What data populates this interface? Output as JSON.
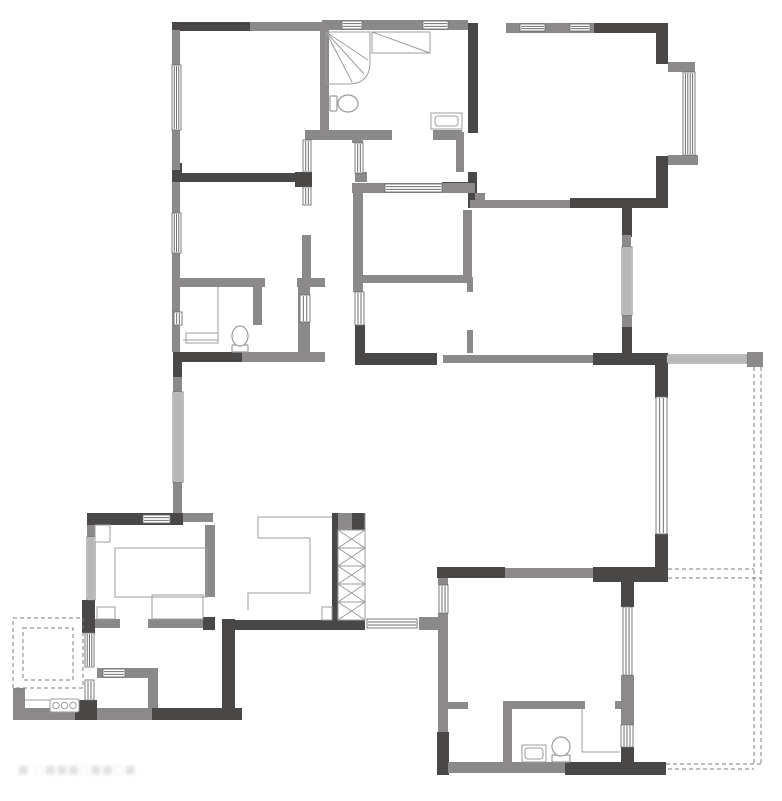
{
  "title": "apartment-floor-plan",
  "watermark": {
    "text": "■ □■■■□■■□■"
  },
  "colors": {
    "wall_dark": "#4a4747",
    "wall_mid": "#8b8989",
    "thin_line": "#9c9c9c",
    "window_frame": "#6f6f6f",
    "dashed": "#7d7d7d",
    "background": "#ffffff"
  },
  "plan": {
    "width": 782,
    "height": 801,
    "walls_dark": [
      [
        172,
        22,
        78,
        9
      ],
      [
        594,
        23,
        74,
        10
      ],
      [
        656,
        23,
        12,
        41
      ],
      [
        656,
        156,
        12,
        52
      ],
      [
        468,
        23,
        10,
        110
      ],
      [
        468,
        172,
        9,
        36
      ],
      [
        570,
        198,
        98,
        10
      ],
      [
        172,
        163,
        10,
        19
      ],
      [
        172,
        173,
        138,
        9
      ],
      [
        295,
        172,
        17,
        15
      ],
      [
        442,
        182,
        33,
        9
      ],
      [
        622,
        208,
        10,
        29
      ],
      [
        622,
        325,
        10,
        40
      ],
      [
        173,
        352,
        9,
        26
      ],
      [
        173,
        352,
        69,
        10
      ],
      [
        355,
        325,
        10,
        40
      ],
      [
        355,
        353,
        82,
        12
      ],
      [
        593,
        353,
        74,
        12
      ],
      [
        655,
        353,
        13,
        45
      ],
      [
        655,
        534,
        13,
        48
      ],
      [
        593,
        567,
        75,
        15
      ],
      [
        437,
        567,
        68,
        11
      ],
      [
        87,
        513,
        96,
        12
      ],
      [
        82,
        600,
        13,
        33
      ],
      [
        75,
        700,
        22,
        20
      ],
      [
        152,
        708,
        90,
        12
      ],
      [
        222,
        619,
        13,
        91
      ],
      [
        203,
        617,
        12,
        13
      ],
      [
        235,
        620,
        130,
        10
      ],
      [
        332,
        513,
        6,
        109
      ],
      [
        348,
        513,
        17,
        17
      ],
      [
        437,
        732,
        12,
        43
      ],
      [
        565,
        762,
        101,
        13
      ],
      [
        621,
        578,
        13,
        29
      ],
      [
        621,
        747,
        13,
        28
      ]
    ],
    "walls_mid": [
      [
        250,
        22,
        72,
        9
      ],
      [
        322,
        20,
        146,
        10
      ],
      [
        506,
        23,
        88,
        10
      ],
      [
        668,
        62,
        27,
        10
      ],
      [
        668,
        155,
        30,
        10
      ],
      [
        172,
        30,
        8,
        140
      ],
      [
        320,
        23,
        9,
        110
      ],
      [
        305,
        130,
        87,
        10
      ],
      [
        433,
        130,
        29,
        10
      ],
      [
        456,
        132,
        8,
        40
      ],
      [
        352,
        133,
        11,
        10
      ],
      [
        355,
        172,
        12,
        10
      ],
      [
        172,
        182,
        8,
        170
      ],
      [
        302,
        235,
        9,
        48
      ],
      [
        175,
        278,
        90,
        9
      ],
      [
        297,
        278,
        28,
        9
      ],
      [
        253,
        287,
        9,
        38
      ],
      [
        298,
        287,
        12,
        65
      ],
      [
        242,
        352,
        83,
        10
      ],
      [
        352,
        183,
        123,
        10
      ],
      [
        353,
        193,
        10,
        99
      ],
      [
        363,
        275,
        107,
        8
      ],
      [
        463,
        210,
        9,
        67
      ],
      [
        467,
        277,
        6,
        15
      ],
      [
        467,
        330,
        6,
        23
      ],
      [
        470,
        200,
        100,
        8
      ],
      [
        475,
        193,
        10,
        10
      ],
      [
        622,
        235,
        9,
        12
      ],
      [
        622,
        315,
        10,
        12
      ],
      [
        443,
        355,
        150,
        8
      ],
      [
        173,
        377,
        9,
        15
      ],
      [
        173,
        482,
        9,
        31
      ],
      [
        183,
        513,
        30,
        9
      ],
      [
        87,
        525,
        8,
        12
      ],
      [
        95,
        619,
        25,
        9
      ],
      [
        148,
        619,
        55,
        9
      ],
      [
        205,
        525,
        10,
        72
      ],
      [
        97,
        668,
        61,
        10
      ],
      [
        148,
        678,
        10,
        30
      ],
      [
        13,
        688,
        12,
        32
      ],
      [
        13,
        708,
        62,
        12
      ],
      [
        97,
        708,
        55,
        12
      ],
      [
        338,
        513,
        14,
        17
      ],
      [
        419,
        617,
        19,
        13
      ],
      [
        438,
        578,
        10,
        7
      ],
      [
        438,
        613,
        10,
        17
      ],
      [
        438,
        630,
        10,
        102
      ],
      [
        448,
        702,
        20,
        7
      ],
      [
        503,
        701,
        82,
        8
      ],
      [
        615,
        701,
        7,
        8
      ],
      [
        503,
        709,
        9,
        53
      ],
      [
        448,
        762,
        117,
        11
      ],
      [
        505,
        568,
        88,
        10
      ],
      [
        621,
        675,
        13,
        50
      ],
      [
        747,
        352,
        16,
        15
      ]
    ],
    "windows": [
      [
        172,
        65,
        9,
        65,
        "v",
        3
      ],
      [
        172,
        213,
        9,
        40,
        "v",
        3
      ],
      [
        174,
        312,
        8,
        13,
        "v",
        2
      ],
      [
        173,
        392,
        10,
        90,
        "v",
        4
      ],
      [
        87,
        537,
        8,
        63,
        "v",
        3
      ],
      [
        85,
        633,
        9,
        34,
        "v",
        3
      ],
      [
        85,
        680,
        9,
        20,
        "v",
        2
      ],
      [
        143,
        515,
        27,
        8,
        "h",
        2
      ],
      [
        103,
        669,
        22,
        8,
        "h",
        2
      ],
      [
        342,
        21,
        20,
        8,
        "h",
        2
      ],
      [
        423,
        21,
        25,
        8,
        "h",
        2
      ],
      [
        520,
        24,
        25,
        7,
        "h",
        2
      ],
      [
        570,
        24,
        20,
        7,
        "h",
        2
      ],
      [
        683,
        72,
        12,
        83,
        "v",
        4
      ],
      [
        303,
        140,
        8,
        32,
        "v",
        2
      ],
      [
        303,
        187,
        8,
        18,
        "v",
        2
      ],
      [
        355,
        143,
        8,
        30,
        "v",
        2
      ],
      [
        385,
        184,
        57,
        8,
        "h",
        2
      ],
      [
        355,
        292,
        9,
        33,
        "v",
        2
      ],
      [
        300,
        295,
        10,
        27,
        "v",
        2
      ],
      [
        622,
        247,
        10,
        68,
        "v",
        4
      ],
      [
        656,
        397,
        11,
        137,
        "v",
        2
      ],
      [
        667,
        355,
        80,
        8,
        "h",
        3
      ],
      [
        439,
        585,
        9,
        28,
        "v",
        2
      ],
      [
        623,
        607,
        9,
        68,
        "v",
        2
      ],
      [
        621,
        725,
        12,
        22,
        "v",
        3
      ],
      [
        367,
        619,
        50,
        9,
        "h",
        2
      ]
    ],
    "furniture_rects": [
      [
        115,
        548,
        92,
        49
      ],
      [
        95,
        525,
        15,
        17
      ],
      [
        152,
        595,
        51,
        24
      ],
      [
        97,
        607,
        18,
        12
      ],
      [
        372,
        32,
        58,
        21
      ],
      [
        431,
        113,
        31,
        16
      ],
      [
        522,
        745,
        24,
        17
      ],
      [
        186,
        333,
        32,
        10
      ],
      [
        322,
        607,
        10,
        13
      ]
    ],
    "sink_inners": [
      [
        435,
        116,
        23,
        10
      ],
      [
        525,
        748,
        18,
        11
      ]
    ],
    "thin_lines": [
      [
        372,
        32,
        430,
        53
      ],
      [
        218,
        287,
        218,
        340
      ],
      [
        183,
        340,
        218,
        340
      ],
      [
        582,
        709,
        582,
        752
      ],
      [
        582,
        752,
        620,
        752
      ],
      [
        25,
        700,
        80,
        700
      ],
      [
        365,
        513,
        365,
        620
      ]
    ],
    "cabinet_path": "M332,517 L258,517 L258,538 L310,538 L310,593 L248,593 L248,610",
    "dashed_rects": [
      [
        13,
        618,
        70,
        70
      ],
      [
        23,
        628,
        50,
        52
      ]
    ],
    "dashed_lines": [
      [
        754,
        367,
        754,
        766
      ],
      [
        761,
        367,
        761,
        766
      ],
      [
        668,
        569,
        754,
        569
      ],
      [
        668,
        578,
        761,
        578
      ],
      [
        666,
        764,
        761,
        764
      ],
      [
        668,
        769,
        754,
        769
      ]
    ],
    "toilets": [
      {
        "x": 330,
        "y": 94,
        "w": 28,
        "h": 19,
        "dir": "e"
      },
      {
        "x": 231,
        "y": 325,
        "w": 18,
        "h": 28,
        "dir": "s"
      },
      {
        "x": 551,
        "y": 736,
        "w": 20,
        "h": 27,
        "dir": "s"
      }
    ],
    "shower": {
      "x": 326,
      "y": 32,
      "w": 44,
      "h": 52
    },
    "stove": {
      "x": 50,
      "y": 699,
      "w": 29,
      "h": 13,
      "burners": 3
    },
    "shaft_hatch": {
      "x": 338,
      "y": 530,
      "w": 27,
      "h": 90,
      "cells": 5
    }
  }
}
